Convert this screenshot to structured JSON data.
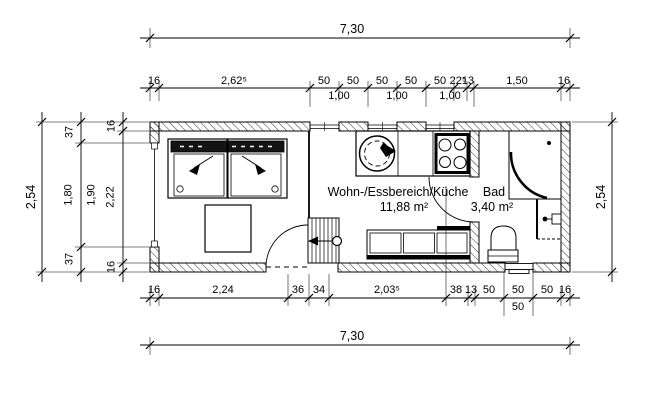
{
  "rooms": {
    "living": {
      "label": "Wohn-/Essbereich/Küche",
      "area": "11,88 m²"
    },
    "bath": {
      "label": "Bad",
      "area": "3,40 m²"
    }
  },
  "dims": {
    "top_total": "7,30",
    "bottom_total": "7,30",
    "left_total": "2,54",
    "right_total": "2,54",
    "top_chain": [
      "16",
      "2,62⁵",
      "50",
      "50",
      "50",
      "50",
      "50",
      "22⁵",
      "13",
      "1,50",
      "16"
    ],
    "top_sub": [
      "1,00",
      "1,00",
      "1,00"
    ],
    "bottom_chain": [
      "16",
      "2,24",
      "36",
      "34",
      "2,03⁵",
      "38",
      "13",
      "50",
      "50",
      "50",
      "16"
    ],
    "bottom_sub": [
      "50"
    ],
    "left_outer_chain": [
      "37",
      "1,80",
      "37"
    ],
    "left_mid": "1,90",
    "left_inner_chain": [
      "16",
      "2,22",
      "16"
    ]
  },
  "fixtures": [
    "double-bed",
    "side-table",
    "kitchen-counter",
    "sink",
    "cooktop",
    "dining-bench",
    "space-saver-stairs",
    "entrance-door",
    "bath-door",
    "corner-shower",
    "washbasin",
    "toilet",
    "windows"
  ],
  "colors": {
    "line": "#000000",
    "background": "#ffffff"
  }
}
